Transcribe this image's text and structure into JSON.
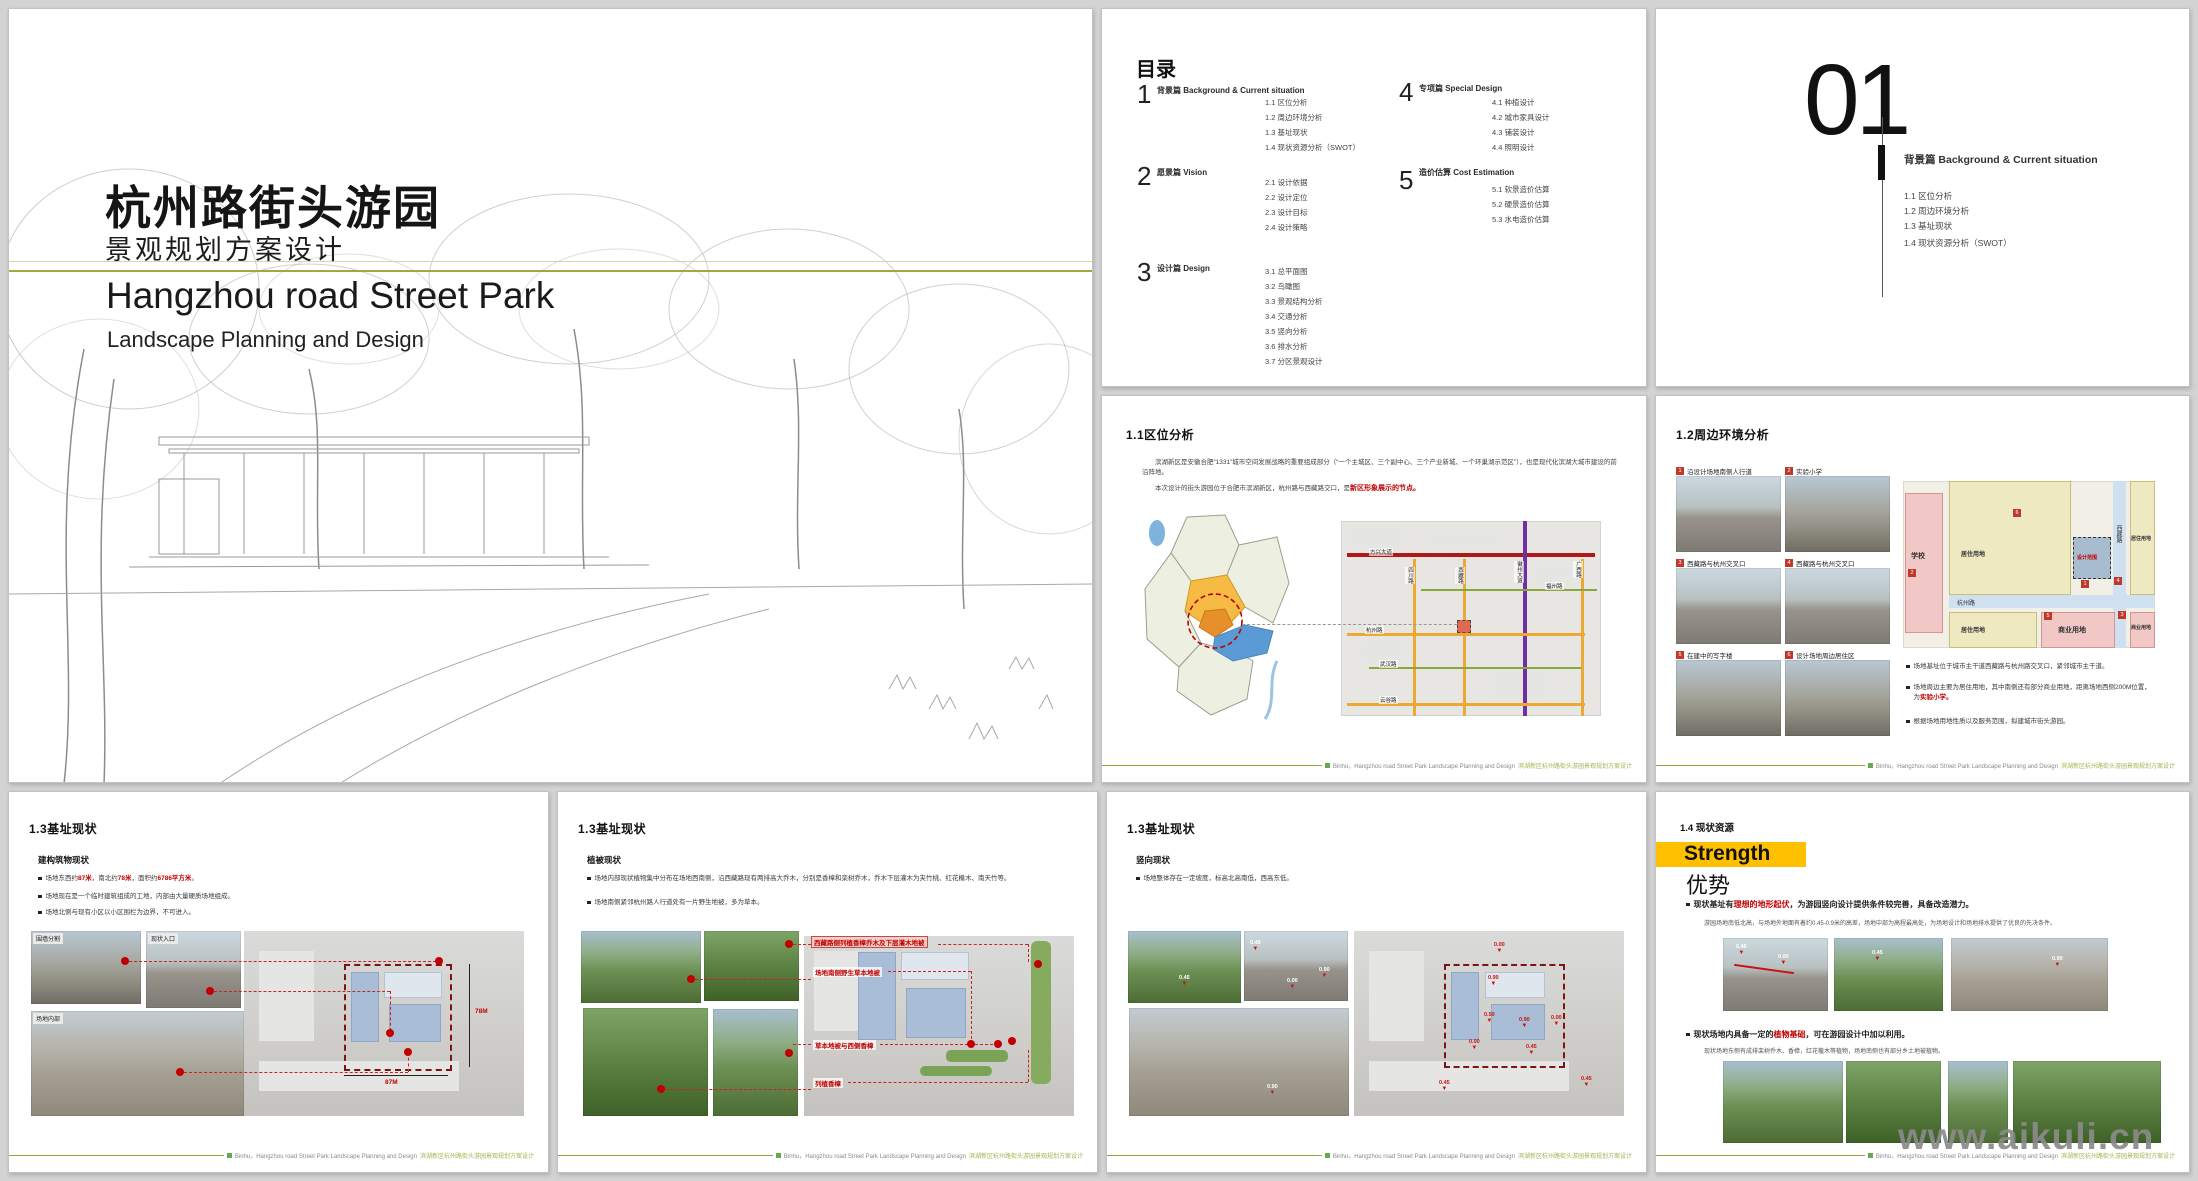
{
  "watermark": "www.aikuli.cn",
  "footer": {
    "en": "Binhu，Hangzhou road Street Park Landscape Planning and Design",
    "zh": "滨湖新区杭州路街头游园景观规划方案设计"
  },
  "title_slide": {
    "title_zh": "杭州路街头游园",
    "subtitle_zh": "景观规划方案设计",
    "title_en": "Hangzhou road Street Park",
    "subtitle_en": "Landscape Planning and Design"
  },
  "toc": {
    "heading": "目录",
    "sections": [
      {
        "num": "1",
        "label": "背景篇  Background &  Current situation",
        "items": [
          "1.1  区位分析",
          "1.2  周边环境分析",
          "1.3  基址现状",
          "1.4  现状资源分析（SWOT）"
        ]
      },
      {
        "num": "2",
        "label": "愿景篇  Vision",
        "items": [
          "2.1  设计依据",
          "2.2  设计定位",
          "2.3  设计目标",
          "2.4  设计策略"
        ]
      },
      {
        "num": "3",
        "label": "设计篇  Design",
        "items": [
          "3.1 总平面图",
          "3.2 鸟瞰图",
          "3.3 景观结构分析",
          "3.4 交通分析",
          "3.5 竖向分析",
          "3.6 排水分析",
          "3.7 分区景观设计"
        ]
      },
      {
        "num": "4",
        "label": "专项篇  Special Design",
        "items": [
          "4.1 种植设计",
          "4.2 城市家具设计",
          "4.3 铺装设计",
          "4.4 照明设计"
        ]
      },
      {
        "num": "5",
        "label": "造价估算  Cost Estimation",
        "items": [
          "5.1 软景造价估算",
          "5.2 硬景造价估算",
          "5.3 水电造价估算"
        ]
      }
    ]
  },
  "divider": {
    "number": "01",
    "label": "背景篇  Background &  Current situation",
    "items": [
      "1.1  区位分析",
      "1.2  周边环境分析",
      "1.3  基址现状",
      "1.4  现状资源分析（SWOT）"
    ]
  },
  "location": {
    "title": "1.1区位分析",
    "para1": "滨湖新区是安徽合肥“1331”城市空间发展战略的重要组成部分（“一个主城区、三个副中心、三个产业新城、一个环巢湖示范区”），也是现代化滨湖大城市建设的前沿阵地。",
    "para2_pre": "本次设计的街头游园位于合肥市滨湖新区，杭州路与西藏路交口，是",
    "para2_red": "新区形象展示的节点。",
    "map": {
      "road_red": "方兴大道",
      "road_h1": "杭州路",
      "road_h2": "武汉路",
      "road_h3": "云谷路",
      "road_green": "福州路",
      "road_v1": "四川路",
      "road_v2": "西藏路",
      "road_v3": "徽州大道",
      "road_v4": "广西路"
    }
  },
  "surroundings": {
    "title": "1.2周边环境分析",
    "photos": [
      {
        "num": "1",
        "label": "沿设计场地南侧人行道"
      },
      {
        "num": "2",
        "label": "实验小学"
      },
      {
        "num": "3",
        "label": "西藏路与杭州交叉口"
      },
      {
        "num": "4",
        "label": "西藏路与杭州交叉口"
      },
      {
        "num": "5",
        "label": "在建中的写字楼"
      },
      {
        "num": "6",
        "label": "设计场地周边居住区"
      }
    ],
    "map": {
      "school": "学校",
      "residential1": "居住用地",
      "residential2": "居住用地",
      "residential3": "居住用地",
      "commercial1": "商业用地",
      "commercial2": "商业用地",
      "road_h": "杭州路",
      "road_v": "西藏路",
      "site": "设计范围",
      "m1": "1",
      "m2": "2",
      "m3": "3",
      "m4": "4",
      "m5": "5",
      "m6": "6"
    },
    "b1": "场地基址位于城市主干道西藏路与杭州路交叉口，紧邻城市主干道。",
    "b2_pre": "场地周边主要为居住用地，其中南侧还有部分商业用地，距离场地西侧200M位置，为",
    "b2_red": "实验小学。",
    "b3": "根据场地用地性质以及服务范围，拟建城市街头游园。"
  },
  "site1": {
    "title": "1.3基址现状",
    "subtitle": "建构筑物现状",
    "b1_p1": "场地东西约",
    "b1_r1": "87米",
    "b1_p2": "，南北约",
    "b1_r2": "78米",
    "b1_p3": "，面积约",
    "b1_r3": "6786平方米",
    "b1_p4": "。",
    "b2": "场地现在是一个临时建筑组成的工地，内部由大量硬质场地组成。",
    "b3": "场地北侧与现有小区以小区围栏为边界，不可进入。",
    "tag1": "围墙分割",
    "tag2": "现状入口",
    "tag3": "场地内部",
    "dim_v": "78M",
    "dim_h": "87M"
  },
  "site2": {
    "title": "1.3基址现状",
    "subtitle": "植被现状",
    "b1": "场地内部现状植物集中分布在场地西南侧，沿西藏路现有两排高大乔木，分别是香樟和栾树乔木，乔木下层灌木为夹竹桃、红花檵木、南天竹等。",
    "b2": "场地南侧紧邻杭州路人行道处有一片野生地被，多为草本。",
    "a1": "西藏路侧列植香樟乔木及下层灌木地被",
    "a2": "场地南侧野生草本地被",
    "a3": "草本地被与西侧香樟",
    "a4": "列植香樟"
  },
  "site3": {
    "title": "1.3基址现状",
    "subtitle": "竖向现状",
    "b1": "场地整体存在一定坡度，标高北高南低，西高东低。",
    "photo_marks": [
      "0.45",
      "0.45",
      "0.00",
      "0.90",
      "0.90"
    ],
    "plan_marks": [
      "0.00",
      "0.90",
      "0.50",
      "0.90",
      "0.00",
      "0.45",
      "0.00",
      "0.45",
      "0.45"
    ]
  },
  "resources": {
    "title": "1.4 现状资源",
    "strength_en": "Strength",
    "strength_zh": "优势",
    "b1_pre": "现状基址有",
    "b1_red": "理想的地形起伏",
    "b1_post": "，为游园竖向设计提供条件较完善，具备改造潜力。",
    "note1": "游园场地南低北高，与场地外地面有着约0.45-0.9米的高差，场地中部为高程最高处，为场地设计和场地排水提供了优良的先决条件。",
    "marks": [
      "0.45",
      "0.00",
      "0.45",
      "0.90"
    ],
    "b2_pre": "现状场地内具备一定的",
    "b2_red": "植物基础",
    "b2_post": "，可在游园设计中加以利用。",
    "note2": "现状场地东侧有成排栾树乔木、香樟，红花檵木等植物，场地南侧也有部分乡土地被植物。"
  }
}
